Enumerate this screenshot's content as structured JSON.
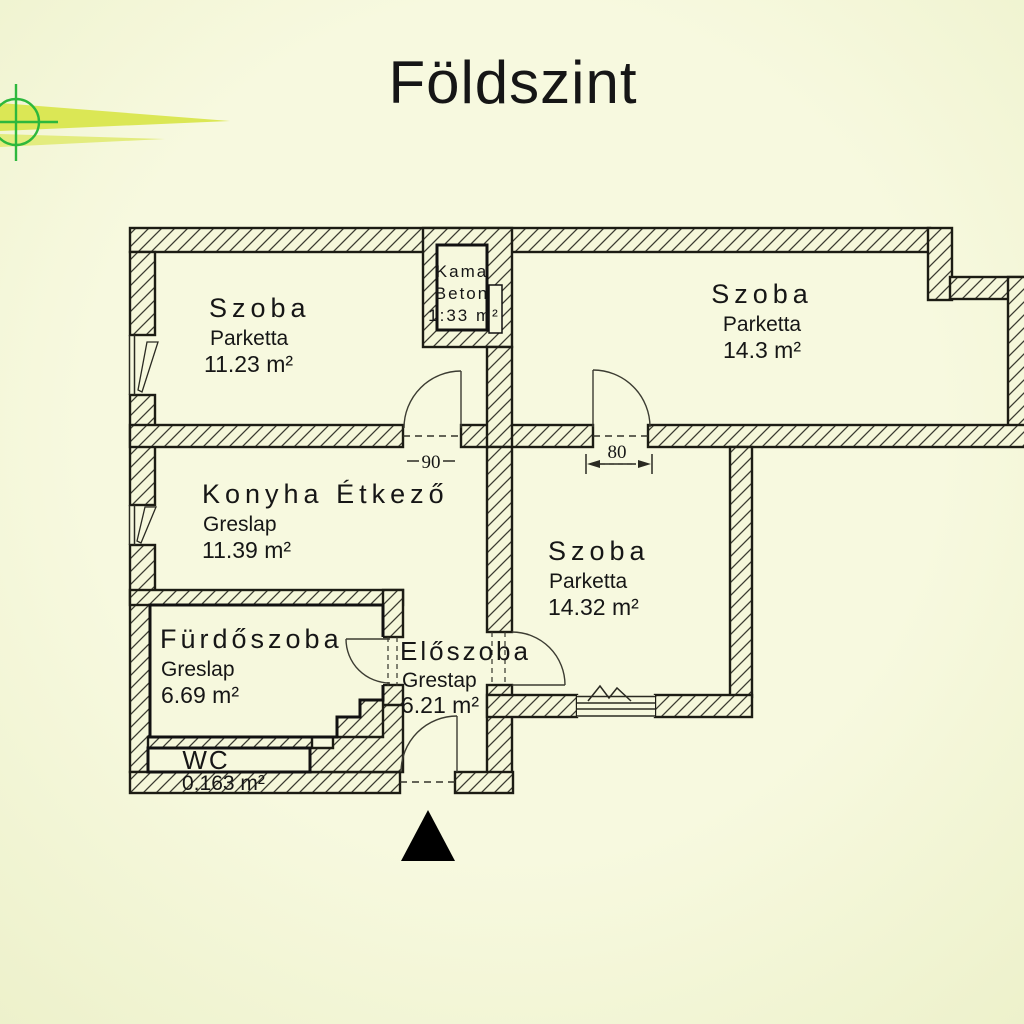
{
  "title": "Földszint",
  "colors": {
    "background": "#f5f7da",
    "wall_outline": "#1c1c14",
    "logo_green": "#2db83d",
    "logo_swoosh": "#dbe755",
    "text": "#161616",
    "north_arrow": "#000000"
  },
  "rooms": [
    {
      "id": "szoba-top-left",
      "name": "Szoba",
      "floor": "Parketta",
      "area": "11.23 m²"
    },
    {
      "id": "kamra",
      "name": "Kama",
      "floor": "Beton",
      "area": "1:33 m²"
    },
    {
      "id": "szoba-top-right",
      "name": "Szoba",
      "floor": "Parketta",
      "area": "14.3 m²"
    },
    {
      "id": "konyha-etkezo",
      "name": "Konyha Étkező",
      "floor": "Greslap",
      "area": "11.39 m²"
    },
    {
      "id": "szoba-middle",
      "name": "Szoba",
      "floor": "Parketta",
      "area": "14.32 m²"
    },
    {
      "id": "furdoszoba",
      "name": "Fürdőszoba",
      "floor": "Greslap",
      "area": "6.69 m²"
    },
    {
      "id": "eloszoba",
      "name": "Előszoba",
      "floor": "Grestap",
      "area": "6.21 m²"
    },
    {
      "id": "wc",
      "name": "WC",
      "floor": "",
      "area": "0.163 m²"
    }
  ],
  "dimensions": [
    {
      "id": "door-konyha",
      "label": "90"
    },
    {
      "id": "door-szoba",
      "label": "80"
    }
  ],
  "icons": {
    "north_arrow": "filled-triangle-up",
    "logo": "crosshair-circle-with-swoosh"
  }
}
